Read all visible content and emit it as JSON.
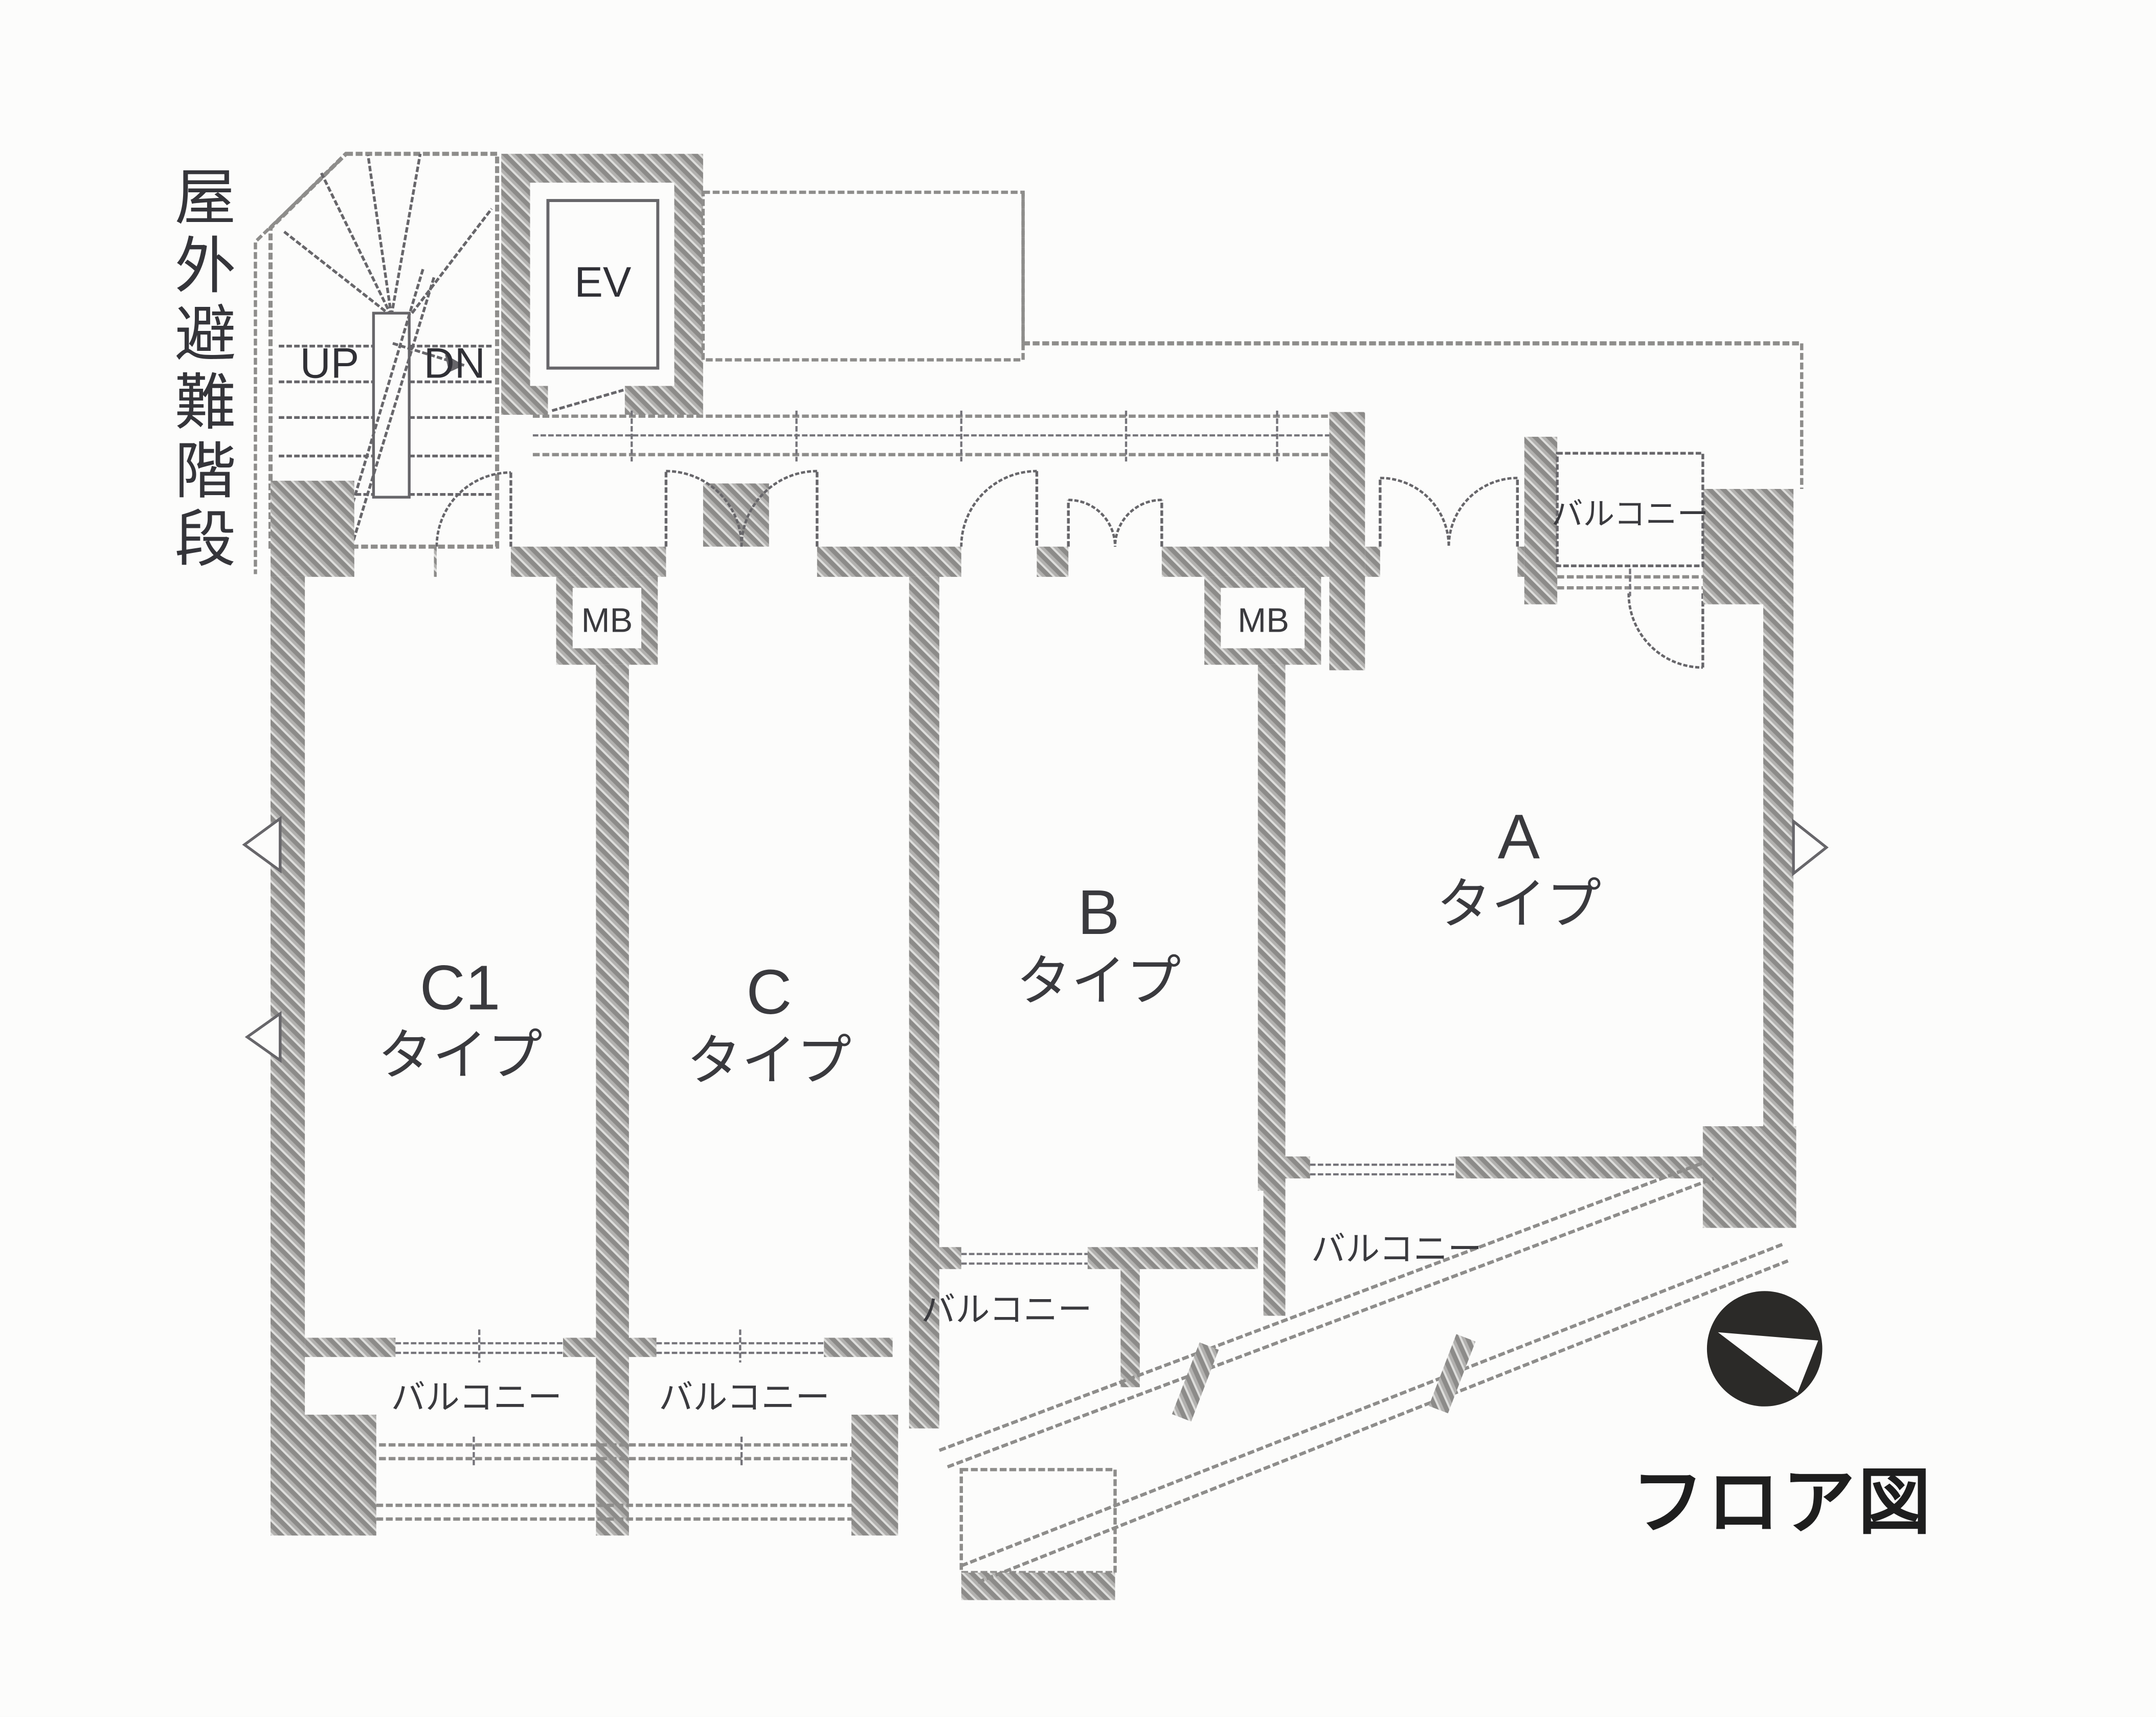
{
  "plan": {
    "caption": "フロア図",
    "emergency_stair_label": "屋外避難階段",
    "stairs": {
      "up": "UP",
      "dn": "DN"
    },
    "elevator_label": "EV",
    "mailbox_label": "MB",
    "balcony_label": "バルコニー",
    "units": [
      {
        "id": "C1",
        "name": "C1",
        "type_suffix": "タイプ"
      },
      {
        "id": "C",
        "name": "C",
        "type_suffix": "タイプ"
      },
      {
        "id": "B",
        "name": "B",
        "type_suffix": "タイプ"
      },
      {
        "id": "A",
        "name": "A",
        "type_suffix": "タイプ"
      }
    ],
    "colors": {
      "wall_hatch": "#9e9d9b",
      "boundary_line": "#8e8d8b",
      "detail_line": "#67666a",
      "text": "#3a3a3e",
      "caption_text": "#1e1e1e",
      "compass_fill": "#2b2a28",
      "paper": "#fcfcfb"
    }
  }
}
